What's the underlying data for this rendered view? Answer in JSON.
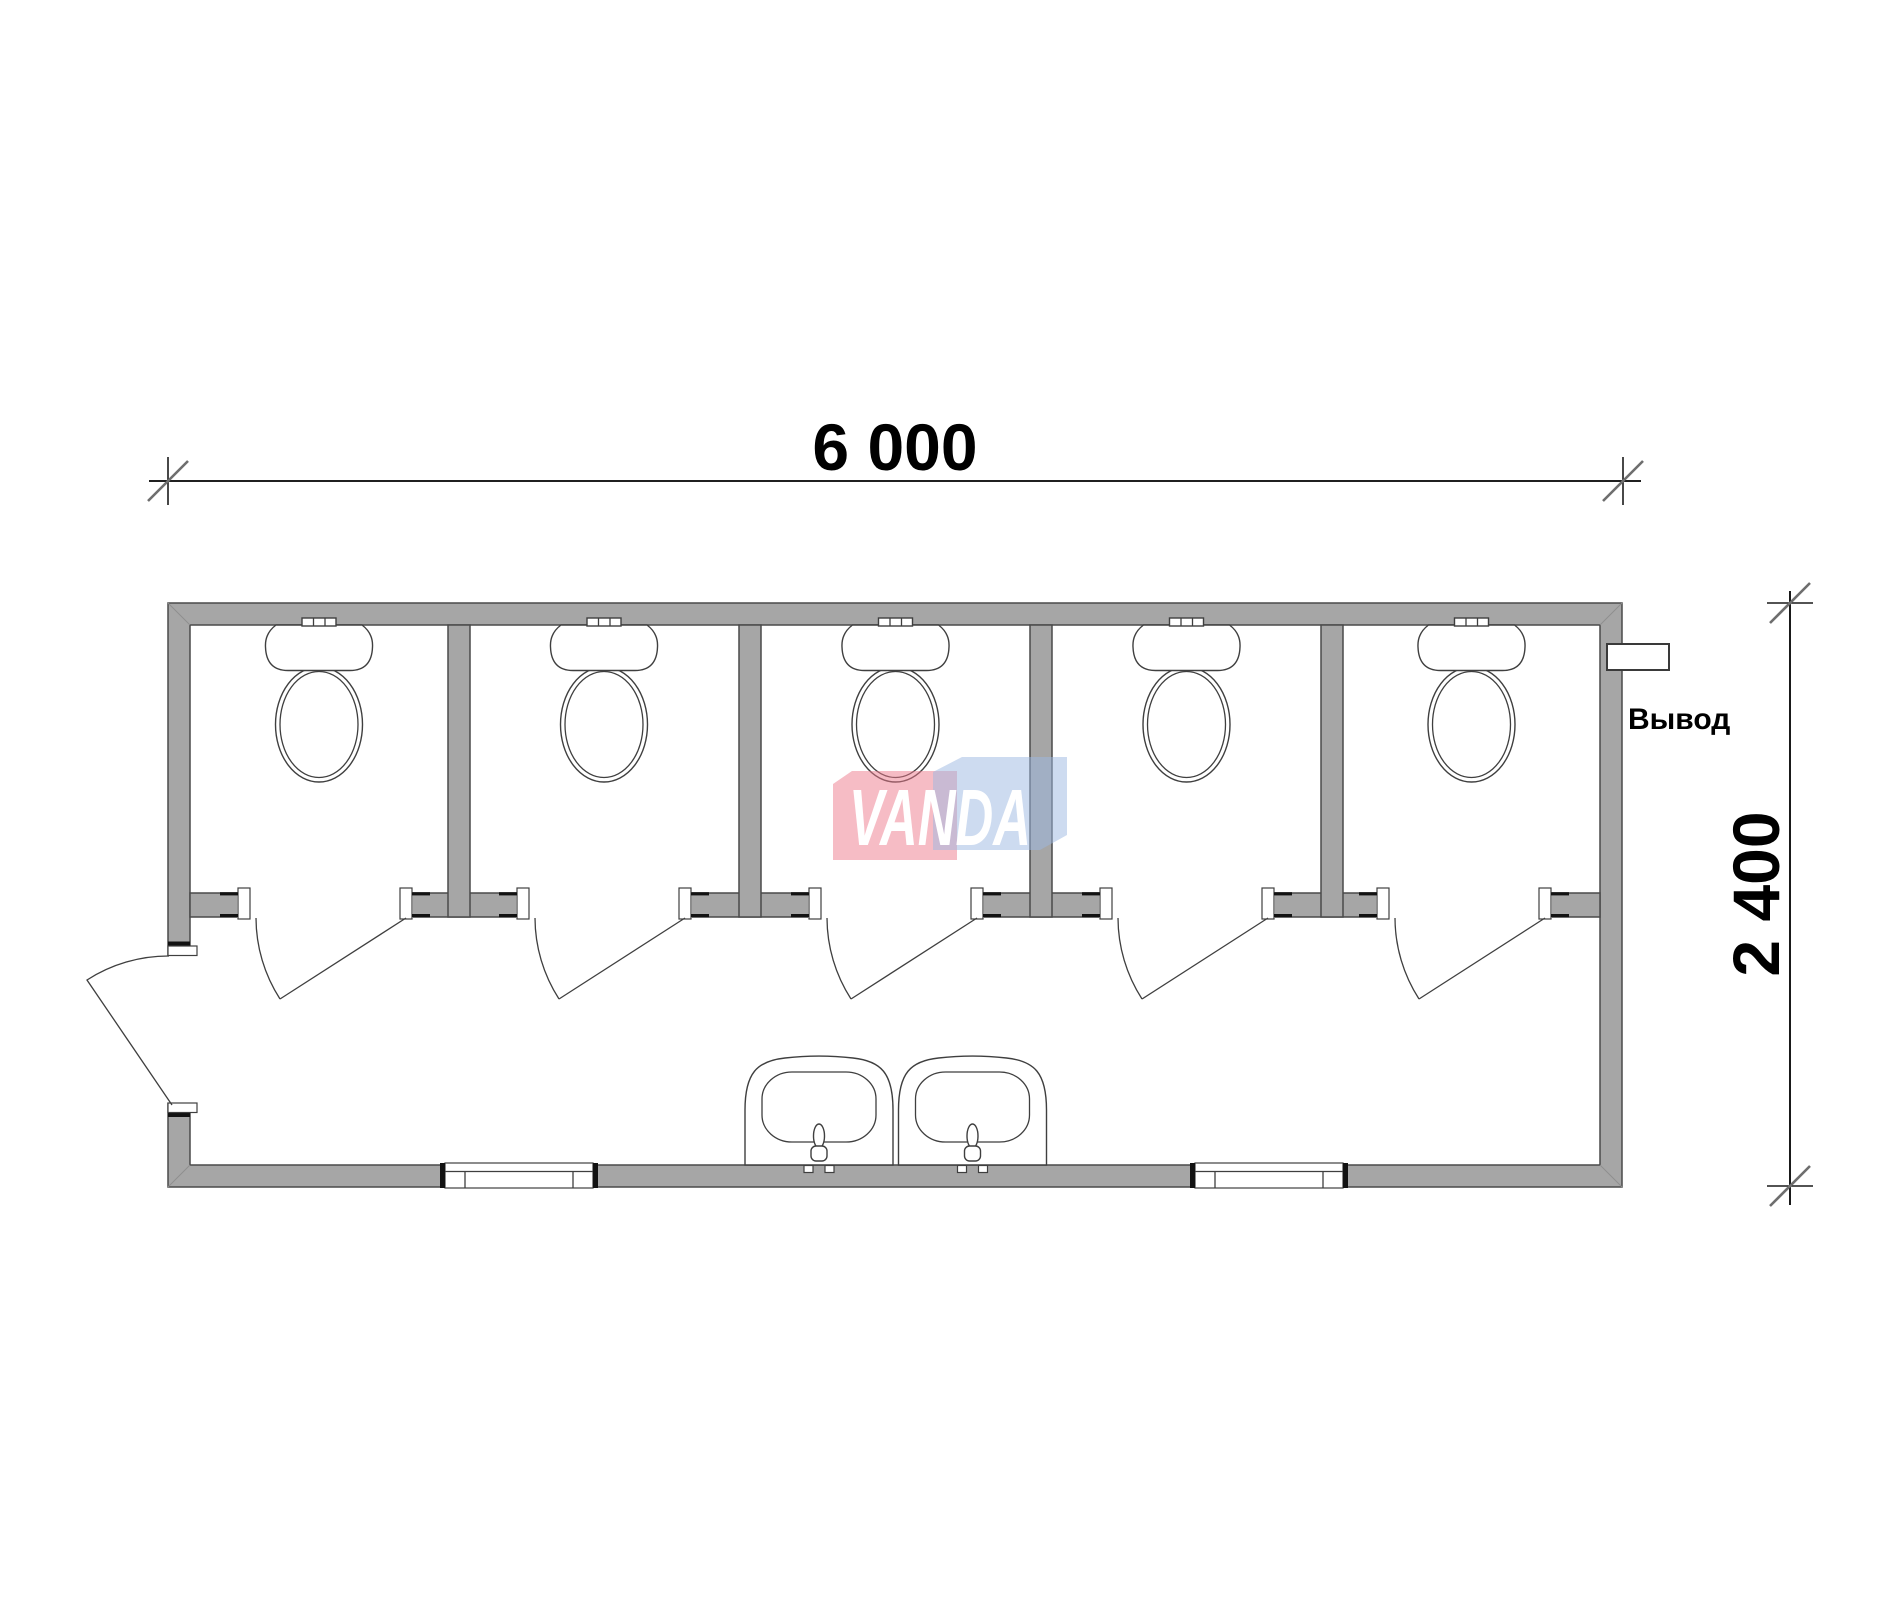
{
  "dimensions": {
    "width_label": "6 000",
    "height_label": "2 400"
  },
  "outlet": {
    "label": "Вывод"
  },
  "logo": {
    "text": "VANDA",
    "pink_hex": "#f6bcc5",
    "blue_hex": "#cddcf0",
    "text_color": "#ffffff"
  },
  "colors": {
    "wall_fill": "#a6a6a6",
    "wall_outline": "#4a4a4a",
    "fixture_line": "#3f3f3f",
    "dimension_line": "#000000"
  },
  "fixtures": {
    "toilet_count": 5,
    "sink_count": 2,
    "stall_door_count": 5,
    "window_count": 2,
    "entry_door_count": 1
  }
}
